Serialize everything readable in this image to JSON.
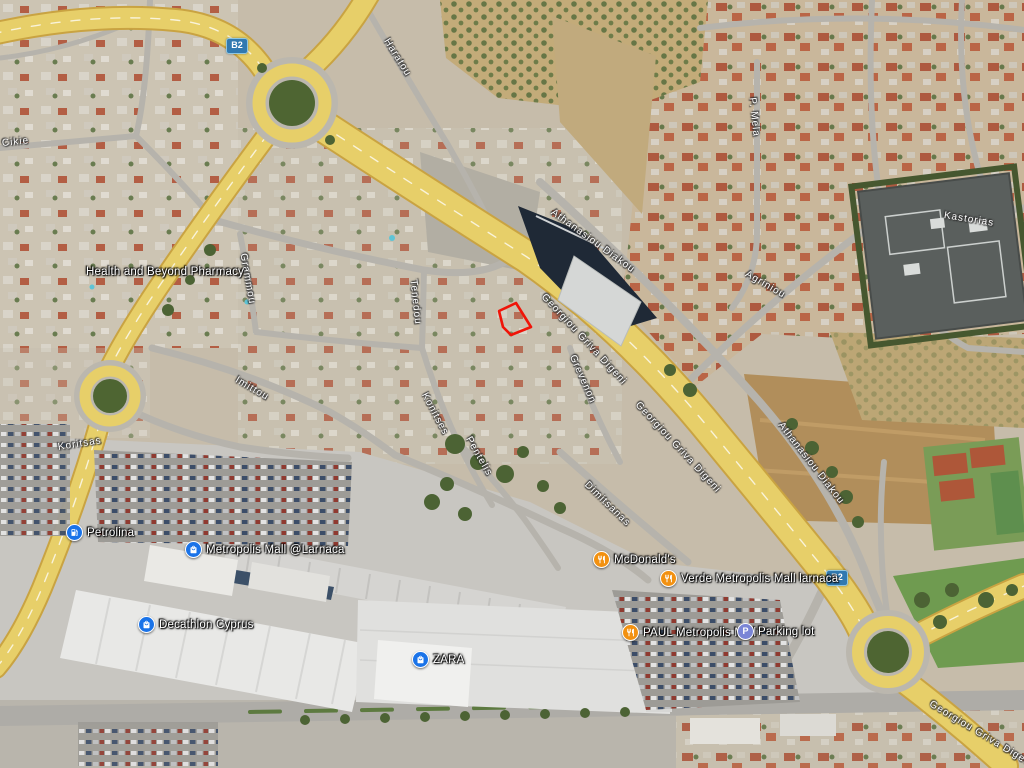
{
  "map": {
    "type": "satellite-hybrid",
    "road_badges": [
      {
        "text": "B2"
      },
      {
        "text": "B2"
      }
    ],
    "street_labels": [
      {
        "text": "Haratou"
      },
      {
        "text": "Athanasiou Diakou"
      },
      {
        "text": "Georgiou Griva Digeni"
      },
      {
        "text": "Georgiou Griva Digeni"
      },
      {
        "text": "Athanasiou Diakou"
      },
      {
        "text": "Grevenon"
      },
      {
        "text": "Grammou"
      },
      {
        "text": "Tenedou"
      },
      {
        "text": "Imittou"
      },
      {
        "text": "Konitses"
      },
      {
        "text": "Pentelis"
      },
      {
        "text": "Dimitsanas"
      },
      {
        "text": "Kastorias"
      },
      {
        "text": "Agriniou"
      },
      {
        "text": "Georgiou Griva Digeni"
      },
      {
        "text": "P. Mela"
      },
      {
        "text": "Cikie"
      },
      {
        "text": "Koritsas"
      }
    ],
    "pois": [
      {
        "name": "Health and Beyond Pharmacy",
        "icon": "none"
      },
      {
        "name": "Petrolina",
        "icon": "fuel"
      },
      {
        "name": "Metropolis Mall @Larnaca",
        "icon": "shopping"
      },
      {
        "name": "Decathlon Cyprus",
        "icon": "shopping"
      },
      {
        "name": "ZARA",
        "icon": "shopping"
      },
      {
        "name": "McDonald's",
        "icon": "food"
      },
      {
        "name": "Verde Metropolis Mall larnaca",
        "icon": "food"
      },
      {
        "name": "PAUL Metropolis Mall",
        "icon": "food"
      },
      {
        "name": "Parking lot",
        "icon": "parking"
      }
    ],
    "colors": {
      "poi_blue": "#1a73e8",
      "poi_orange": "#f29111",
      "poi_parking": "#7a85d6",
      "road_yellow": "#e7cf69",
      "route_badge": "#3179b0",
      "plot_outline_red": "#f01408",
      "roundabout_green": "#4e6532"
    },
    "annotations": [
      {
        "name": "highlighted-plot",
        "shape": "polygon",
        "color": "#f01408"
      }
    ]
  }
}
